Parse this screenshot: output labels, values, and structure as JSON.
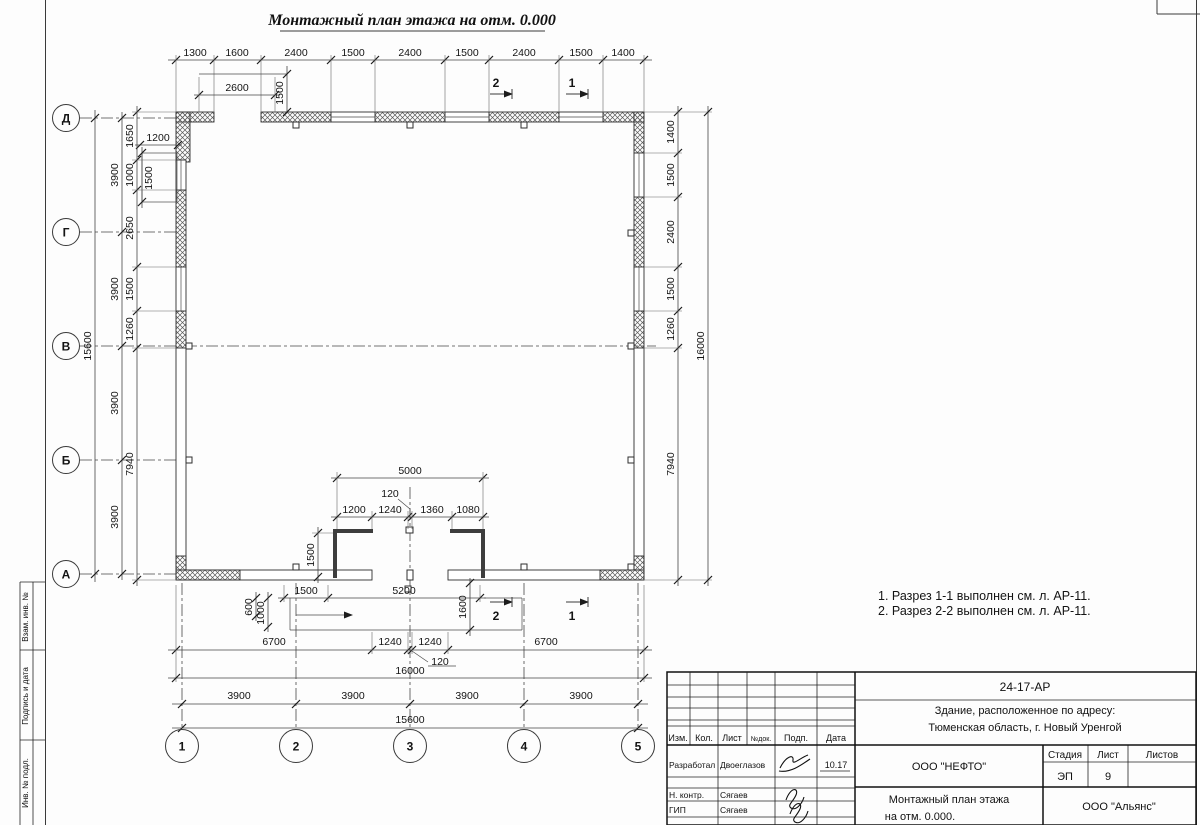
{
  "sheet": {
    "title": "Монтажный план этажа на отм. 0.000",
    "notes": [
      "1. Разрез 1-1 выполнен см. л. АР-11.",
      "2. Разрез 2-2 выполнен см. л. АР-11."
    ]
  },
  "axes": {
    "rows": [
      "Д",
      "Г",
      "В",
      "Б",
      "А"
    ],
    "cols": [
      "1",
      "2",
      "3",
      "4",
      "5"
    ]
  },
  "sections": {
    "one": "1",
    "two": "2"
  },
  "dims": {
    "top": [
      "1300",
      "1600",
      "2400",
      "1500",
      "2400",
      "1500",
      "2400",
      "1500",
      "1400"
    ],
    "gate_w": "2600",
    "gate_h": "1500",
    "well_w": "1200",
    "well_h": "1500",
    "left_total": "15600",
    "left_axis": [
      "3900",
      "3900",
      "3900",
      "3900"
    ],
    "left_inner": [
      "1650",
      "1000",
      "2650",
      "1500",
      "1260",
      "7940"
    ],
    "right_inner": [
      "1400",
      "1500",
      "2400",
      "1500",
      "1260",
      "7940"
    ],
    "right_total": "16000",
    "vest_total": "5000",
    "vest_lead": "120",
    "vest": [
      "1200",
      "1240",
      "1360",
      "1080"
    ],
    "vest_h": "1500",
    "entry_door": "1500",
    "entry_porch": "5200",
    "porch_a": "600",
    "porch_b": "1000",
    "porch_c": "1600",
    "bottom": [
      "6700",
      "1240",
      "1240",
      "6700"
    ],
    "bottom_lead": "120",
    "bottom_total": "16000",
    "bottom_axis": [
      "3900",
      "3900",
      "3900",
      "3900"
    ],
    "bottom_axes_total": "15600"
  },
  "margin": [
    "Взам. инв. №",
    "Подпись и дата",
    "Инв. № подл."
  ],
  "stamp": {
    "code": "24-17-АР",
    "obj1": "Здание, расположенное по адресу:",
    "obj2": "Тюменская область, г. Новый Уренгой",
    "cols": [
      "Изм.",
      "Кол.",
      "Лист",
      "№док.",
      "Подп.",
      "Дата"
    ],
    "staff": [
      {
        "role": "Разработал",
        "name": "Двоеглазов",
        "date": "10.17"
      },
      {
        "role": "Н. контр.",
        "name": "Сягаев",
        "date": ""
      },
      {
        "role": "ГИП",
        "name": "Сягаев",
        "date": ""
      }
    ],
    "company": "ООО \"НЕФТО\"",
    "dtitle1": "Монтажный план этажа",
    "dtitle2": "на отм. 0.000.",
    "stage_label": "Стадия",
    "sheet_label": "Лист",
    "sheets_label": "Листов",
    "stage": "ЭП",
    "sheet_no": "9",
    "org": "ООО \"Альянс\""
  }
}
